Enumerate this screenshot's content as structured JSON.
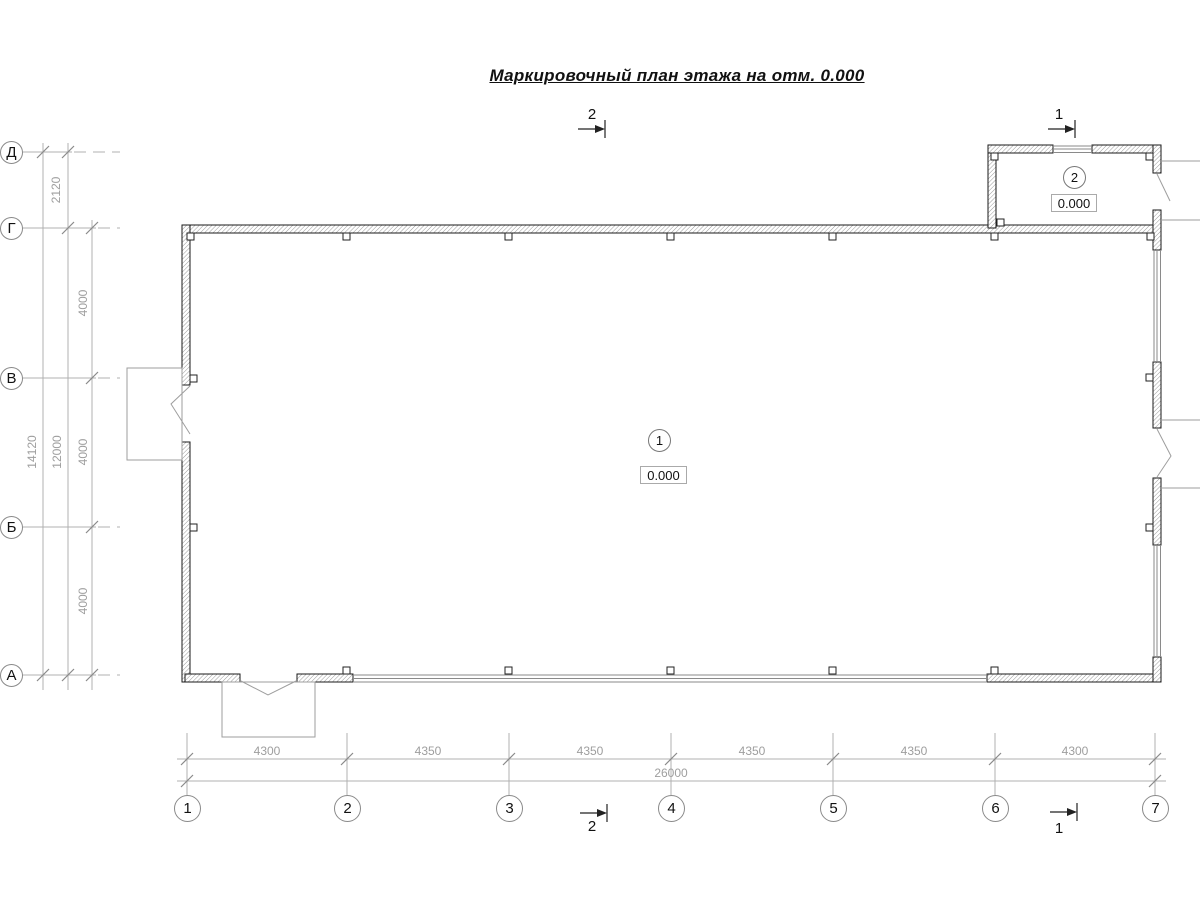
{
  "title": "Маркировочный план этажа на отм. 0.000",
  "sections": {
    "top_2": "2",
    "top_1": "1",
    "bottom_2": "2",
    "bottom_1": "1"
  },
  "grid": {
    "left_axes": [
      "Д",
      "Г",
      "В",
      "Б",
      "А"
    ],
    "bottom_axes": [
      "1",
      "2",
      "3",
      "4",
      "5",
      "6",
      "7"
    ]
  },
  "dims": {
    "left_chain": [
      "2120",
      "4000",
      "4000",
      "4000"
    ],
    "left_subtotal": "12000",
    "left_total": "14120",
    "bottom_chain": [
      "4300",
      "4350",
      "4350",
      "4350",
      "4350",
      "4300"
    ],
    "bottom_total": "26000"
  },
  "rooms": [
    {
      "number": "1",
      "elevation": "0.000"
    },
    {
      "number": "2",
      "elevation": "0.000"
    }
  ],
  "colors": {
    "wall_outline": "#1a1a1a",
    "dimension_line": "#b0b0b0",
    "dimension_text": "#9e9e9e",
    "annotation": "#111111"
  }
}
